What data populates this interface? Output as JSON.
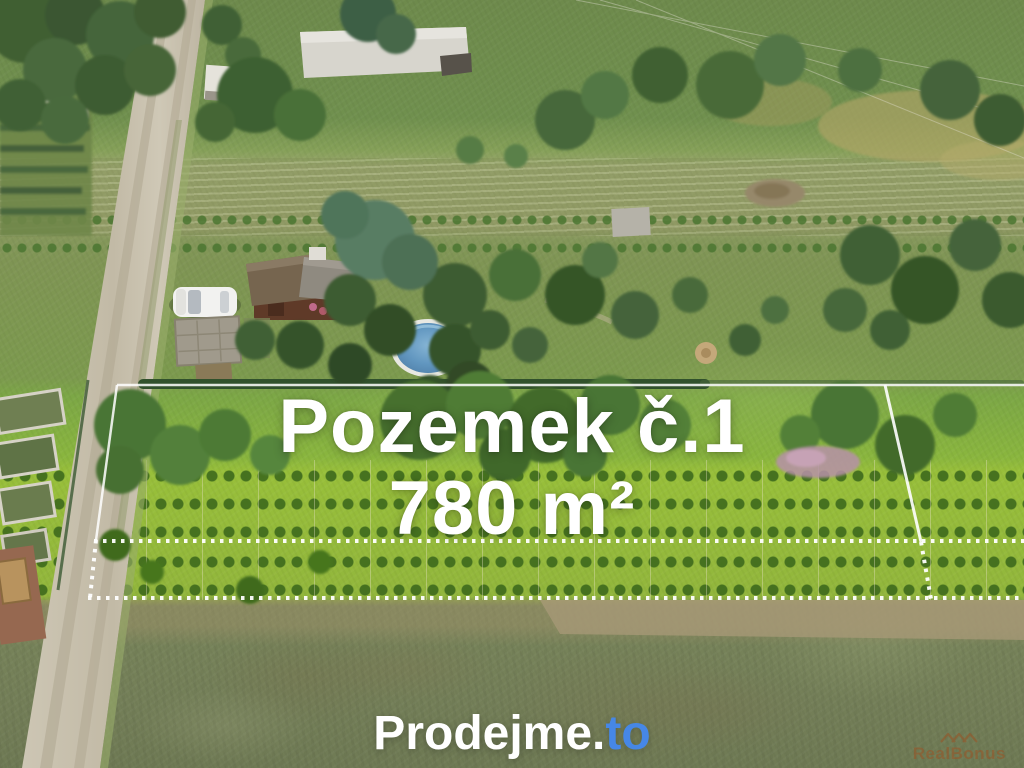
{
  "page": {
    "kind": "real-estate aerial listing banner"
  },
  "overlay": {
    "plot_label": "Pozemek č.1",
    "plot_area": "780 m²",
    "text_color": "#ffffff"
  },
  "logo": {
    "prefix": "Prodejme.",
    "suffix": "to",
    "prefix_color": "#ffffff",
    "suffix_color": "#4687e6"
  },
  "watermark": {
    "text": "RealBonus",
    "color": "#9a5526",
    "icon": "triple-roof-icon"
  },
  "boundary": {
    "color": "#ffffff",
    "style": "solid top/left/right edges, dotted lower edges"
  },
  "palette": {
    "meadow_green": "#7c9a4e",
    "vineyard_lime": "#98bf3a",
    "bottom_field_olive": "#747f58",
    "dirt_road": "#c6bfae",
    "pool_water": "#5d8fb8",
    "cottage_roof_brown": "#76654f",
    "cottage_roof_gray": "#8f8a80",
    "car_white": "#f2f2f0",
    "tree_dark_green": "#3d5c31"
  },
  "scene_objects": [
    "dirt-road",
    "cottage",
    "white-car",
    "round-pool",
    "paved-terrace",
    "vineyard-rows",
    "orchard-trees",
    "garden-beds",
    "hay-field",
    "plot-boundary-outline",
    "adjacent-plot"
  ]
}
